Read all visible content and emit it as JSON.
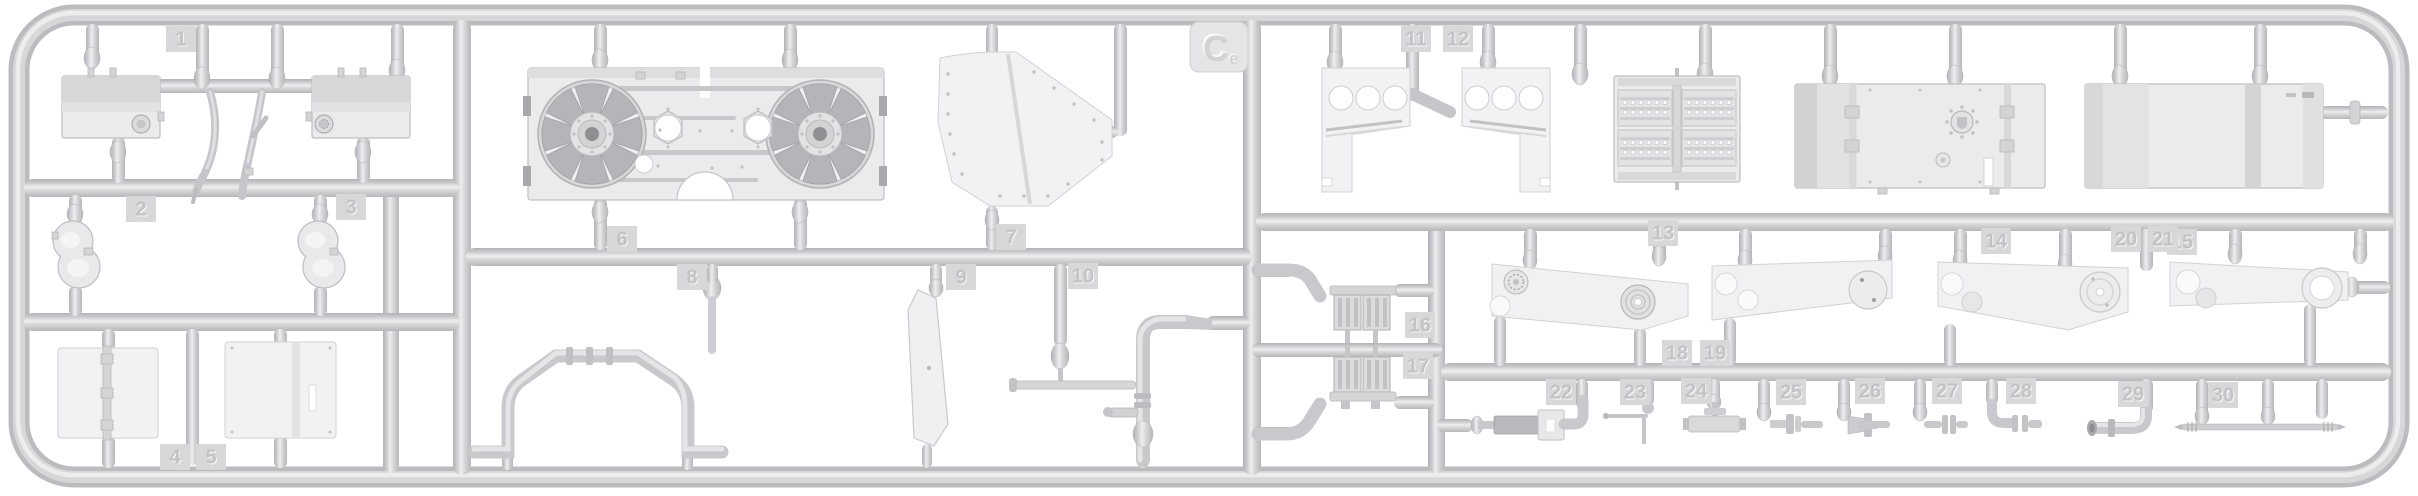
{
  "image": {
    "subject": "grey plastic model kit sprue with numbered parts",
    "background_color": "#ffffff",
    "plastic_light": "#ebebee",
    "plastic_mid": "#cfcfd3",
    "plastic_dark": "#b5b5b9"
  },
  "sprue": {
    "letter": "C",
    "letter_suffix": "e",
    "letter_tab": {
      "x": 1190,
      "y": 22
    },
    "part_tags": [
      {
        "label": "1",
        "x": 166,
        "y": 26
      },
      {
        "label": "2",
        "x": 126,
        "y": 196
      },
      {
        "label": "3",
        "x": 336,
        "y": 194
      },
      {
        "label": "4",
        "x": 160,
        "y": 444
      },
      {
        "label": "5",
        "x": 196,
        "y": 444
      },
      {
        "label": "6",
        "x": 607,
        "y": 226
      },
      {
        "label": "7",
        "x": 996,
        "y": 224
      },
      {
        "label": "8",
        "x": 677,
        "y": 264
      },
      {
        "label": "9",
        "x": 946,
        "y": 264
      },
      {
        "label": "10",
        "x": 1068,
        "y": 263
      },
      {
        "label": "11",
        "x": 1401,
        "y": 26
      },
      {
        "label": "12",
        "x": 1443,
        "y": 26
      },
      {
        "label": "13",
        "x": 1648,
        "y": 220
      },
      {
        "label": "14",
        "x": 1981,
        "y": 228
      },
      {
        "label": "15",
        "x": 2167,
        "y": 229
      },
      {
        "label": "16",
        "x": 1405,
        "y": 312
      },
      {
        "label": "17",
        "x": 1403,
        "y": 353
      },
      {
        "label": "18",
        "x": 1662,
        "y": 340
      },
      {
        "label": "19",
        "x": 1700,
        "y": 340
      },
      {
        "label": "20",
        "x": 2111,
        "y": 226
      },
      {
        "label": "21",
        "x": 2148,
        "y": 226
      },
      {
        "label": "22",
        "x": 1546,
        "y": 379
      },
      {
        "label": "23",
        "x": 1620,
        "y": 379
      },
      {
        "label": "24",
        "x": 1681,
        "y": 378
      },
      {
        "label": "25",
        "x": 1776,
        "y": 379
      },
      {
        "label": "26",
        "x": 1855,
        "y": 378
      },
      {
        "label": "27",
        "x": 1932,
        "y": 378
      },
      {
        "label": "28",
        "x": 2006,
        "y": 378
      },
      {
        "label": "29",
        "x": 2118,
        "y": 381
      },
      {
        "label": "30",
        "x": 2208,
        "y": 382
      }
    ],
    "parts_depicted": [
      "fuel-tank-left",
      "fuel-tank-right",
      "branch-pipes",
      "kidney-pad-left",
      "kidney-pad-right",
      "hatch-panel-left",
      "hatch-panel-right",
      "engine-deck-with-fans",
      "fender-panel",
      "u-shaped-exhaust-pipe",
      "flat-blade",
      "pipe-assembly",
      "bracket-left",
      "bracket-right",
      "louver-grille",
      "large-hatch-panel-1",
      "large-hatch-panel-2",
      "exhaust-manifold-upper",
      "exhaust-manifold-lower",
      "track-run-1",
      "track-run-2",
      "track-run-3",
      "track-run-4",
      "strap-with-buckle",
      "l-shaped-rod",
      "t-muffler",
      "pipe-fitting-1",
      "valve-fitting",
      "flanged-fitting",
      "elbow-fitting",
      "elbow-pipe",
      "tie-rod"
    ]
  }
}
